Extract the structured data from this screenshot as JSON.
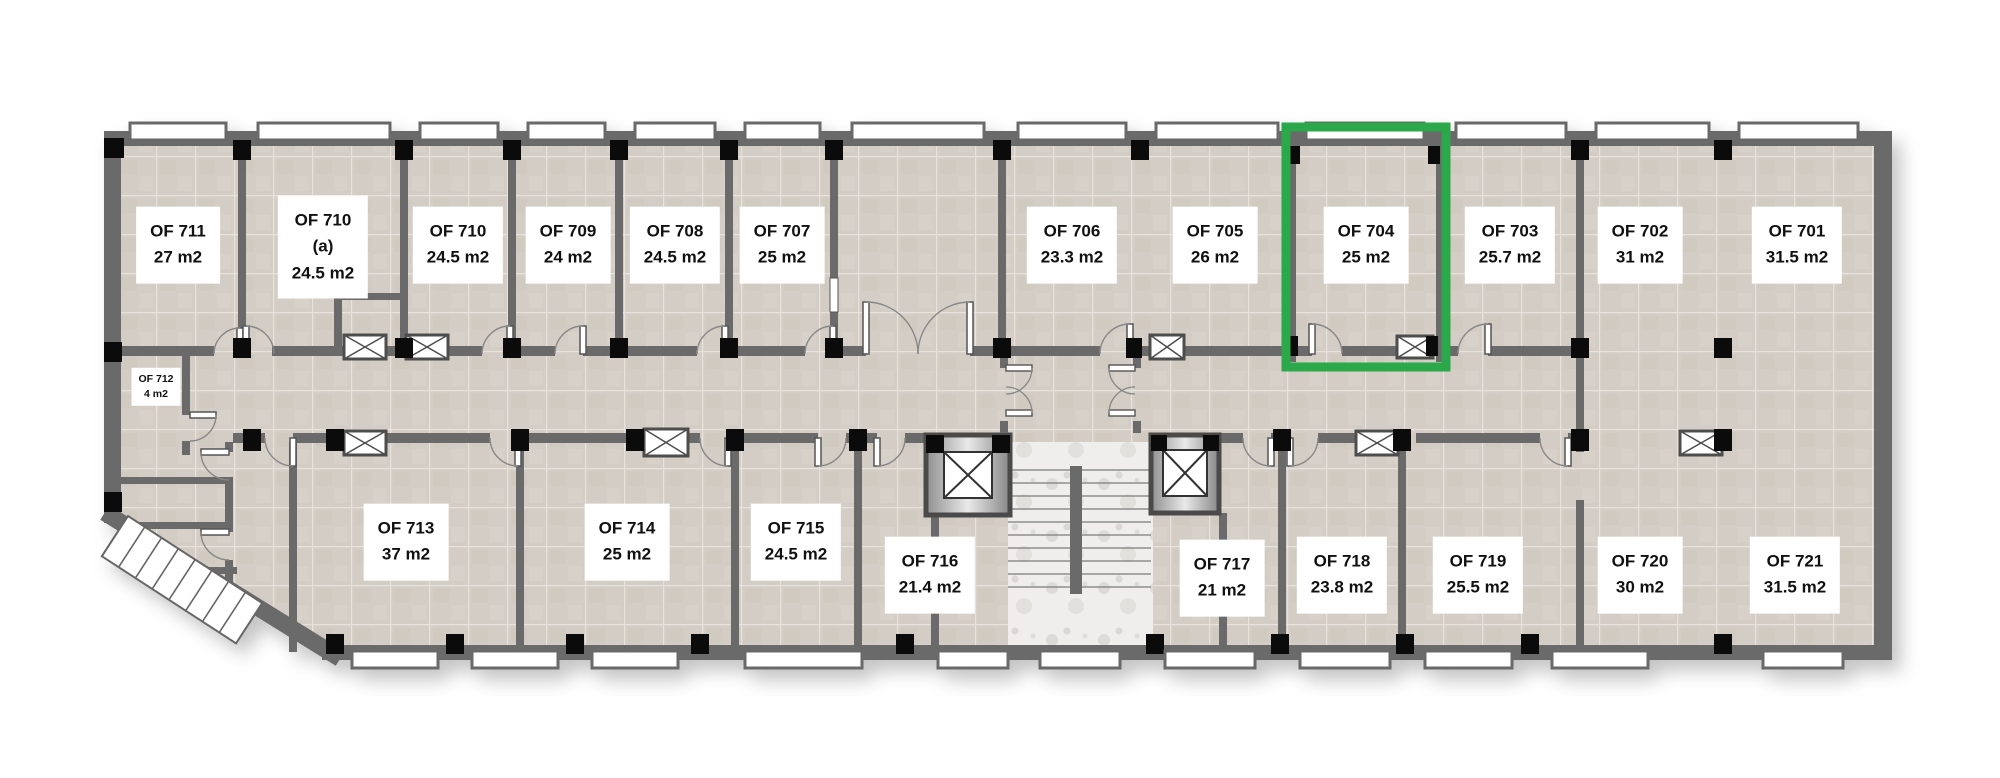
{
  "floor_plan": {
    "selected_room": "OF 704",
    "highlight_color": "#2aa84a",
    "rooms_top": [
      {
        "name": "OF 711",
        "area": "27 m2"
      },
      {
        "name": "OF 710",
        "note": "(a)",
        "area": "24.5 m2"
      },
      {
        "name": "OF 710",
        "area": "24.5 m2"
      },
      {
        "name": "OF 709",
        "area": "24 m2"
      },
      {
        "name": "OF 708",
        "area": "24.5 m2"
      },
      {
        "name": "OF 707",
        "area": "25 m2"
      },
      {
        "name": "OF 706",
        "area": "23.3 m2"
      },
      {
        "name": "OF 705",
        "area": "26 m2"
      },
      {
        "name": "OF 704",
        "area": "25 m2"
      },
      {
        "name": "OF 703",
        "area": "25.7 m2"
      },
      {
        "name": "OF 702",
        "area": "31 m2"
      },
      {
        "name": "OF 701",
        "area": "31.5 m2"
      }
    ],
    "rooms_bottom": [
      {
        "name": "OF 713",
        "area": "37 m2"
      },
      {
        "name": "OF 714",
        "area": "25 m2"
      },
      {
        "name": "OF 715",
        "area": "24.5 m2"
      },
      {
        "name": "OF 716",
        "area": "21.4 m2"
      },
      {
        "name": "OF 717",
        "area": "21 m2"
      },
      {
        "name": "OF 718",
        "area": "23.8 m2"
      },
      {
        "name": "OF 719",
        "area": "25.5 m2"
      },
      {
        "name": "OF 720",
        "area": "30 m2"
      },
      {
        "name": "OF 721",
        "area": "31.5 m2"
      }
    ],
    "room_side": {
      "name": "OF 712",
      "area": "4 m2"
    },
    "symbols": {
      "vent-icon": "crossed rectangle",
      "elevator-icon": "shaft box with X",
      "stairs-icon": "stepped treads"
    }
  }
}
